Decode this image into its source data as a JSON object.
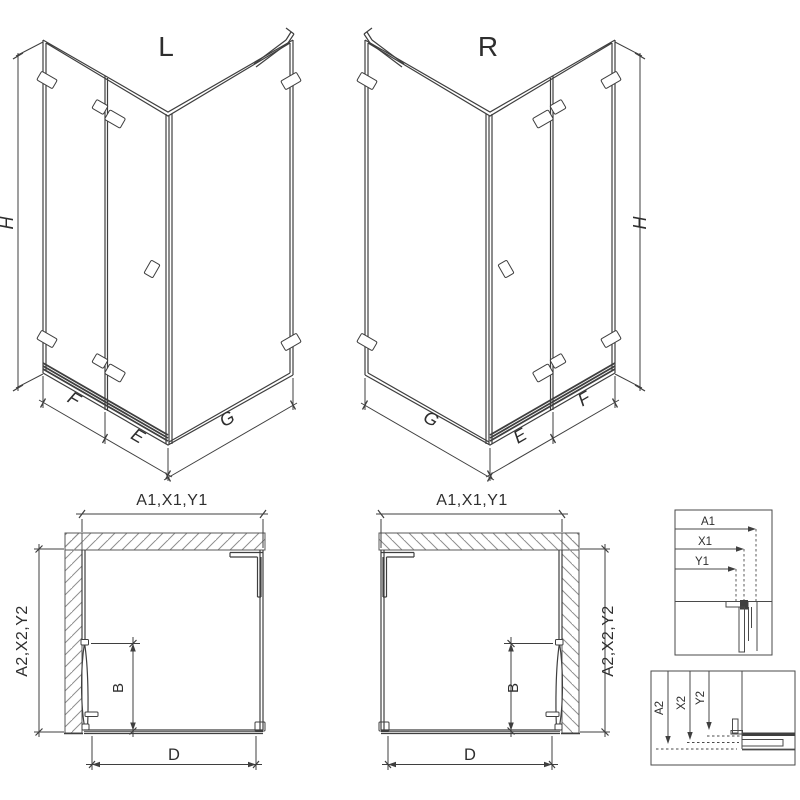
{
  "drawing": {
    "iso_left": {
      "label": "L",
      "height": "H",
      "front_fixed": "F",
      "front_door": "E",
      "side": "G"
    },
    "iso_right": {
      "label": "R",
      "height": "H",
      "front_fixed": "F",
      "front_door": "E",
      "side": "G"
    },
    "plan_left": {
      "top_dims": "A1,X1,Y1",
      "side_dims": "A2,X2,Y2",
      "door_width": "B",
      "entry_width": "D"
    },
    "plan_right": {
      "top_dims": "A1,X1,Y1",
      "side_dims": "A2,X2,Y2",
      "door_width": "B",
      "entry_width": "D"
    },
    "detail_horizontal": {
      "dims": [
        "A1",
        "X1",
        "Y1"
      ]
    },
    "detail_vertical": {
      "dims": [
        "A2",
        "X2",
        "Y2"
      ]
    },
    "colors": {
      "line": "#3f3f3f",
      "text": "#2e2e2e",
      "hatch": "#8f8f8f",
      "wall_outline": "#5a5a5a",
      "background": "#ffffff"
    }
  }
}
